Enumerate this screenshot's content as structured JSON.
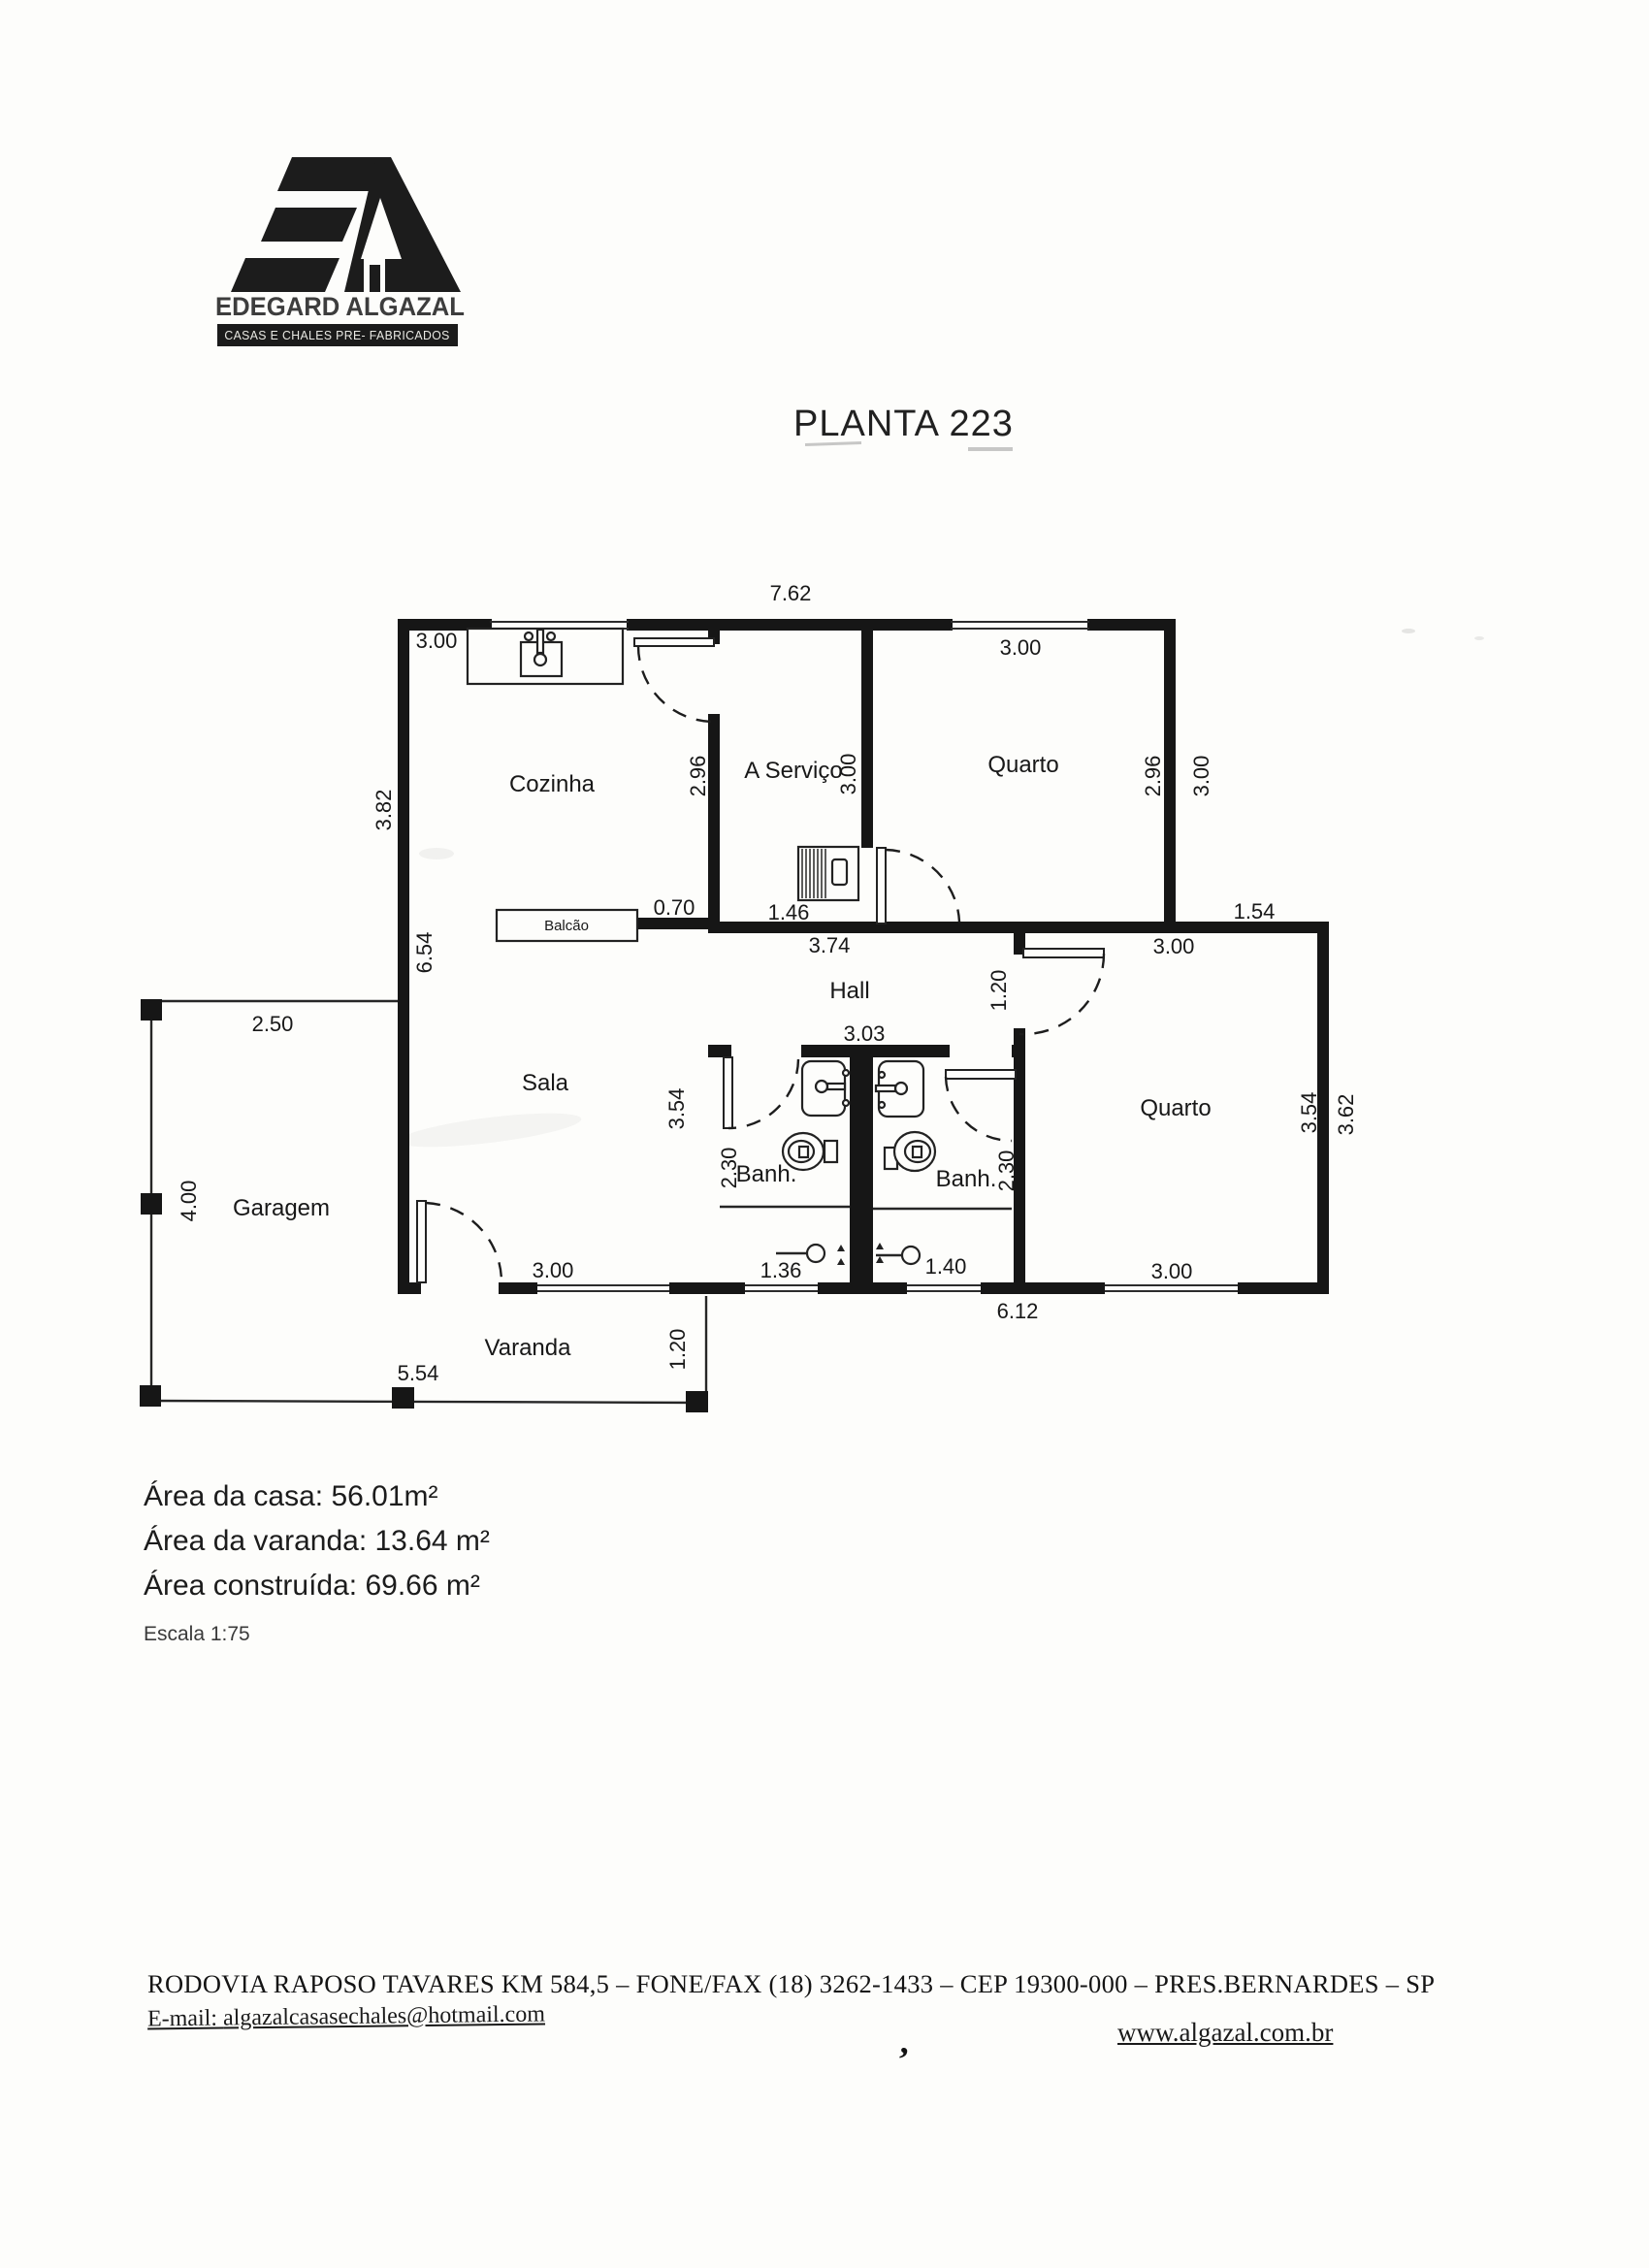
{
  "logo": {
    "company": "EDEGARD ALGAZAL",
    "tagline": "CASAS E CHALES PRE- FABRICADOS"
  },
  "title": "PLANTA 223",
  "plan": {
    "rooms": {
      "cozinha": "Cozinha",
      "servico": "A Serviço",
      "quarto_top": "Quarto",
      "hall": "Hall",
      "sala": "Sala",
      "banh_left": "Banh.",
      "banh_right": "Banh.",
      "quarto_right": "Quarto",
      "garagem": "Garagem",
      "varanda": "Varanda",
      "balcao": "Balcão"
    },
    "dimensions": {
      "top_width": "7.62",
      "cozinha_width": "3.00",
      "cozinha_height": "2.96",
      "left_top": "3.82",
      "left_bottom": "6.54",
      "servico_width": "1.46",
      "servico_height": "3.00",
      "quarto_top_width": "3.00",
      "quarto_top_height_in": "2.96",
      "quarto_top_height_out": "3.00",
      "balcao_wall": "0.70",
      "hall_width": "3.74",
      "hall_lower": "3.03",
      "step_width": "1.54",
      "quarto_right_top": "3.00",
      "door_recess": "1.20",
      "sala_height": "3.54",
      "banh_left_height": "2.30",
      "banh_right_height": "2.30",
      "quarto_right_height_in": "3.54",
      "quarto_right_height_out": "3.62",
      "quarto_right_bottom": "3.00",
      "shower_left": "1.36",
      "shower_right": "1.40",
      "sala_bottom": "3.00",
      "bottom_right": "6.12",
      "garage_width": "2.50",
      "garage_height": "4.00",
      "varanda_width": "5.54",
      "varanda_height": "1.20"
    }
  },
  "summary": {
    "house_area_label": "Área da casa:",
    "house_area_value": "56.01m²",
    "varanda_area_label": "Área da varanda:",
    "varanda_area_value": "13.64 m²",
    "built_area_label": "Área construída: ",
    "built_area_value": "69.66 m²",
    "scale": "Escala 1:75"
  },
  "footer": {
    "address": "RODOVIA RAPOSO TAVARES KM 584,5 – FONE/FAX (18) 3262-1433 – CEP 19300-000 – PRES.BERNARDES – SP",
    "email_label": "E-mail: ",
    "email": "algazalcasasechales@hotmail.com",
    "website": "www.algazal.com.br",
    "ink_mark": "’"
  }
}
